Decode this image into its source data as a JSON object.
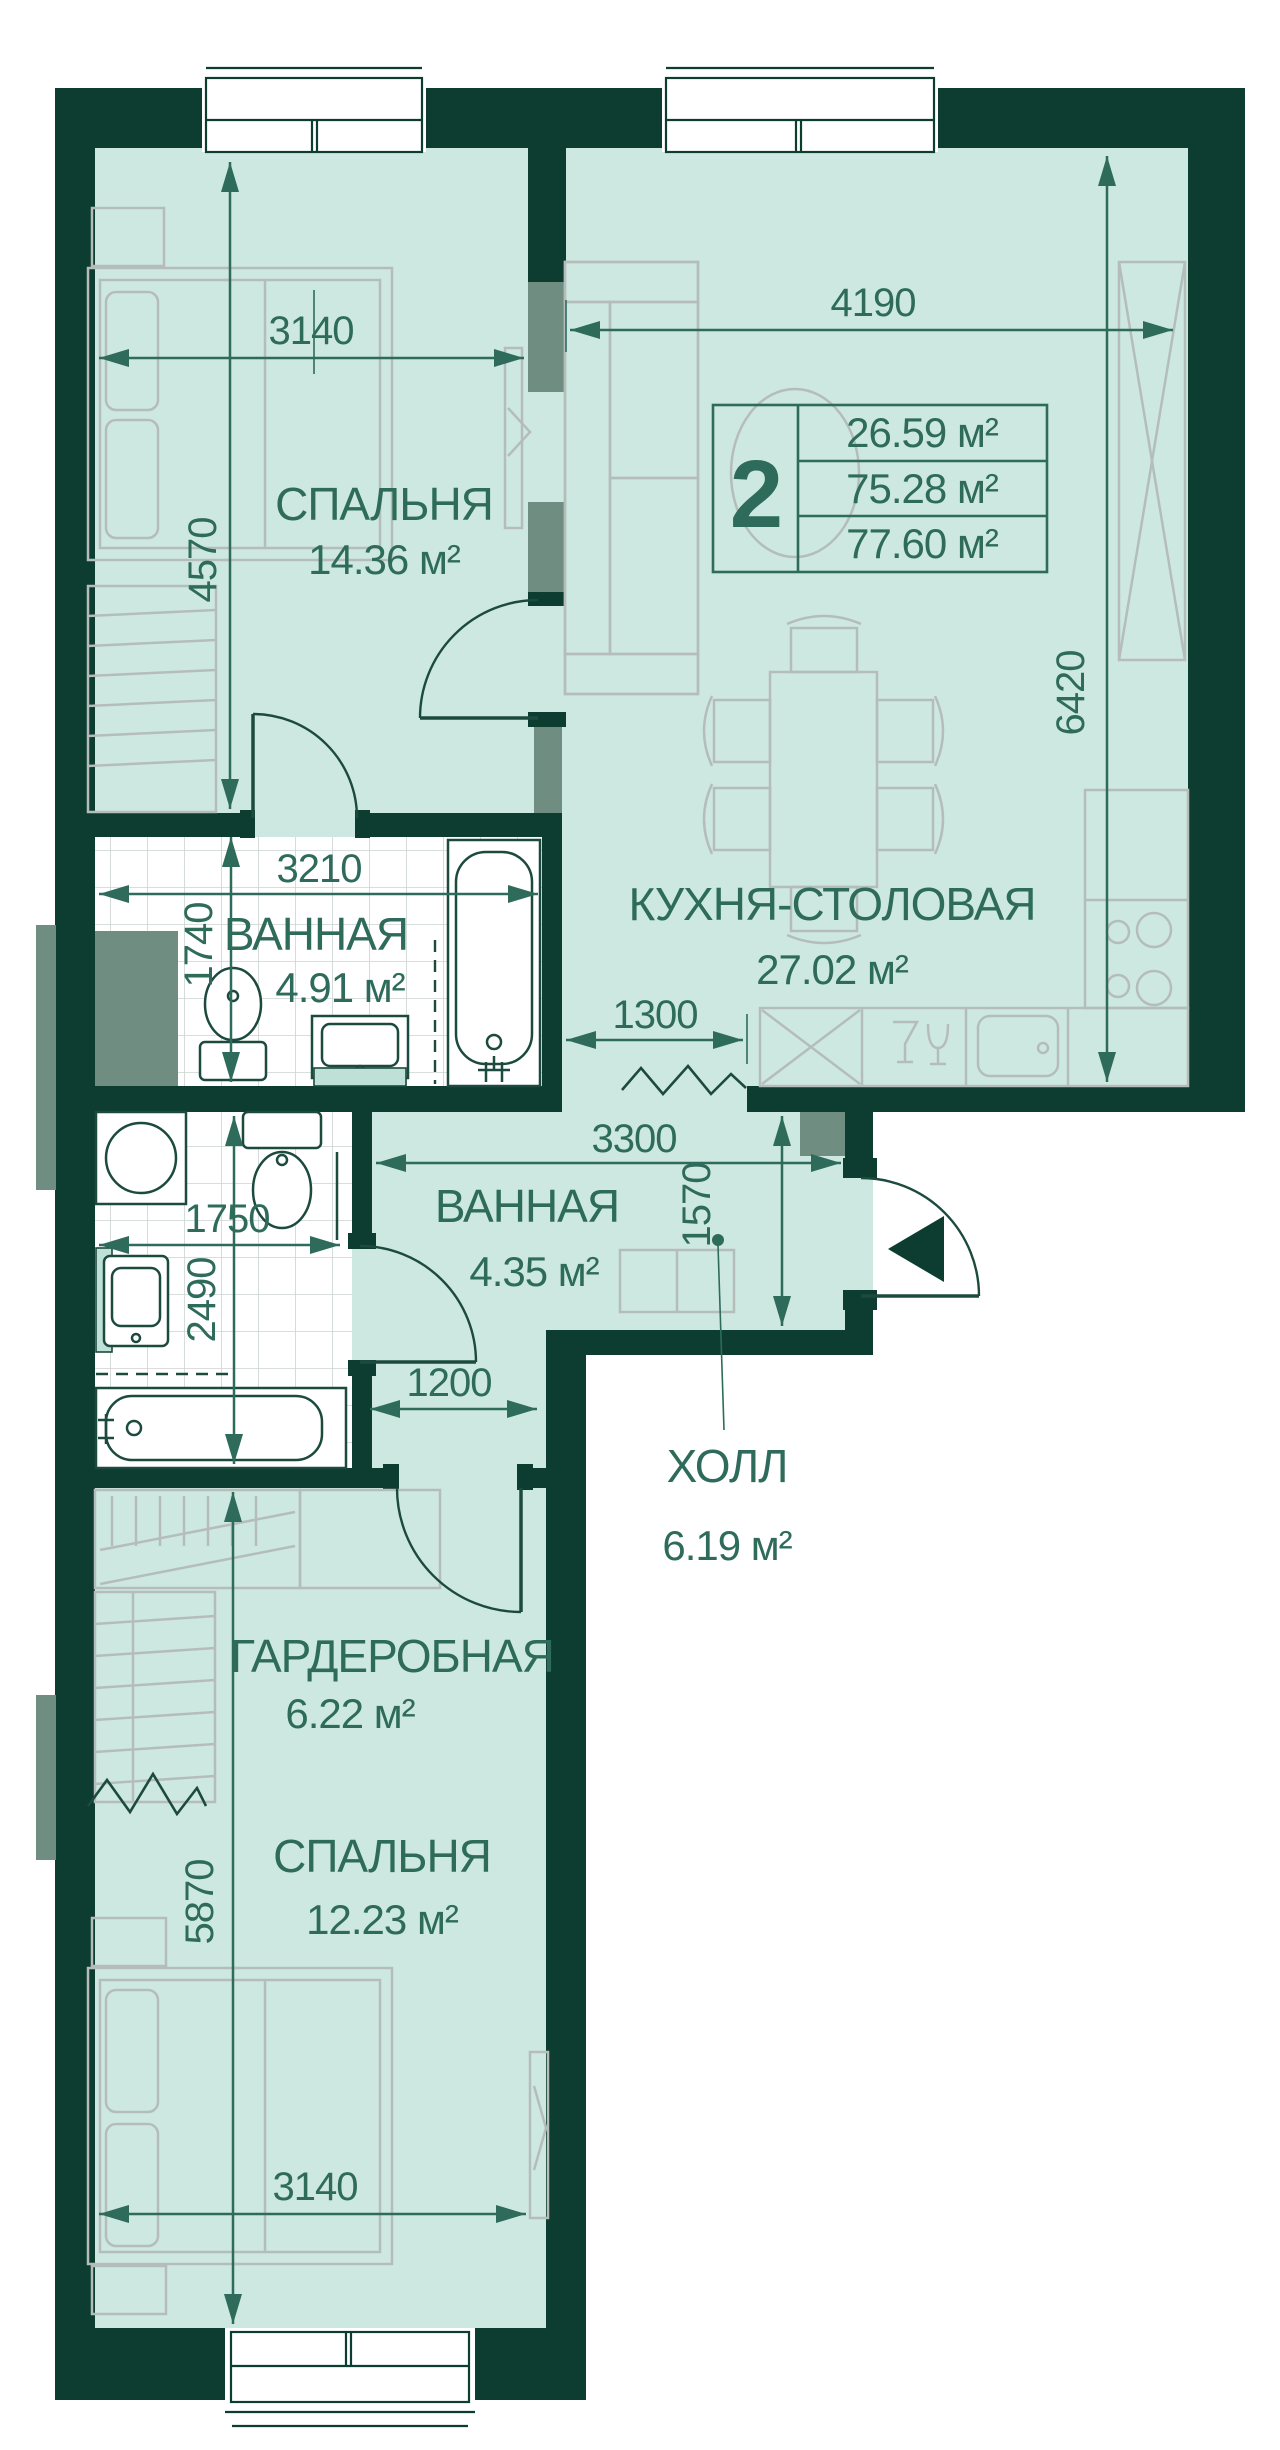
{
  "unit_card": {
    "rooms_count": "2",
    "area_living": "26.59 м²",
    "area_main": "75.28 м²",
    "area_total": "77.60 м²"
  },
  "rooms": [
    {
      "id": "bedroom-1",
      "label": "СПАЛЬНЯ",
      "area": "14.36 м²"
    },
    {
      "id": "kitchen-dining",
      "label": "КУХНЯ-СТОЛОВАЯ",
      "area": "27.02 м²"
    },
    {
      "id": "bathroom-1",
      "label": "ВАННАЯ",
      "area": "4.91 м²"
    },
    {
      "id": "bathroom-2",
      "label": "ВАННАЯ",
      "area": "4.35 м²"
    },
    {
      "id": "hall",
      "label": "ХОЛЛ",
      "area": "6.19 м²"
    },
    {
      "id": "wardrobe",
      "label": "ГАРДЕРОБНАЯ",
      "area": "6.22 м²"
    },
    {
      "id": "bedroom-2",
      "label": "СПАЛЬНЯ",
      "area": "12.23 м²"
    }
  ],
  "dimensions_mm": {
    "bedroom1_width": "3140",
    "bedroom1_depth": "4570",
    "kitchen_width": "4190",
    "kitchen_depth": "6420",
    "bathroom1_width": "3210",
    "bathroom1_depth": "1740",
    "kitchen_passage": "1300",
    "hall_width": "3300",
    "hall_depth": "1570",
    "bathroom2_width": "1750",
    "bathroom2_depth": "2490",
    "wardrobe_door": "1200",
    "bedroom2_depth": "5870",
    "bedroom2_width": "3140"
  },
  "icons": {
    "entry_arrow": "entry-direction-icon",
    "door_swing": "door-swing-icon",
    "break_line": "break-line-icon"
  },
  "colors": {
    "wall": "#0d3c30",
    "floor": "#cde8e0",
    "accent_gray": "#6f8d81",
    "furniture_line": "#b5bdba",
    "dimension": "#2e6b5a",
    "tile_line": "#ccd3d0"
  }
}
